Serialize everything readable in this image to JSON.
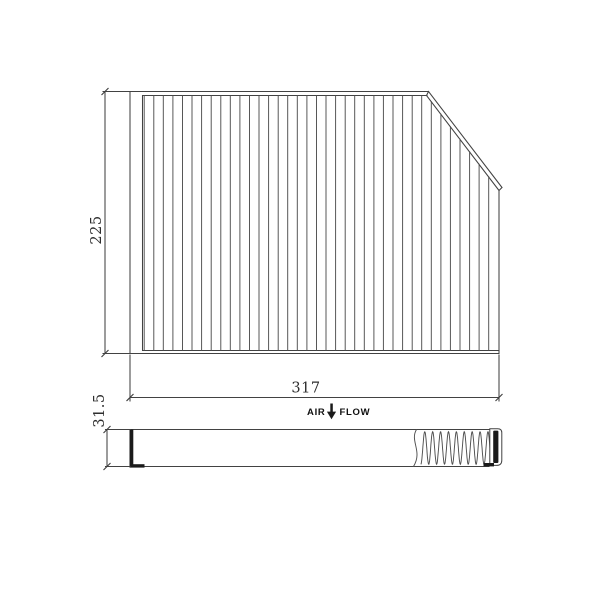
{
  "colors": {
    "background": "#ffffff",
    "line": "#424242",
    "pleat": "#4f4f4f",
    "dark": "#1a1a1a",
    "text": "#2e2e2e"
  },
  "dimensions": {
    "height": "225",
    "width": "317",
    "depth": "31.5"
  },
  "airflow": {
    "label_left": "AIR",
    "label_right": "FLOW",
    "arrow_icon": "arrow-down"
  }
}
